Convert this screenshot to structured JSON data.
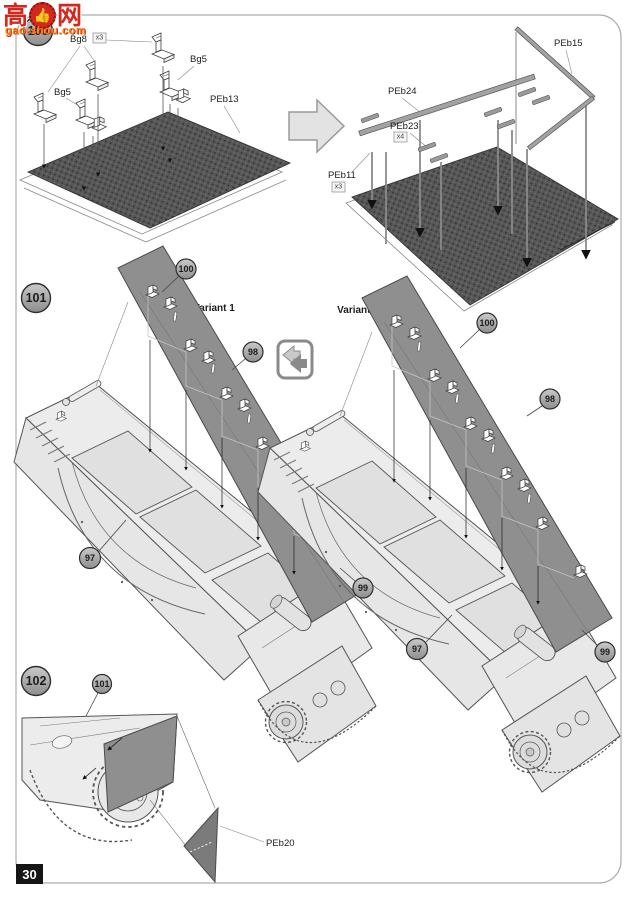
{
  "watermark": {
    "left_char": "高",
    "right_char": "网",
    "thumb": "👍",
    "site": "gao-shou.com"
  },
  "page": {
    "number": "30"
  },
  "colors": {
    "skirt_panel": "#8f8f8f",
    "mesh_plate": "#575757",
    "hull": "#ececec",
    "watermark_red": "#d3281e",
    "watermark_orange": "#ff7a00"
  },
  "steps": {
    "s100": {
      "badge": "100",
      "bg8": "Bg8",
      "bg8_qty": "x3",
      "bg5_a": "Bg5",
      "bg5_b": "Bg5",
      "peb13": "PEb13",
      "peb24": "PEb24",
      "peb23": "PEb23",
      "peb23_qty": "x4",
      "peb11": "PEb11",
      "peb11_qty": "x3",
      "peb15": "PEb15"
    },
    "s101": {
      "badge": "101",
      "variant1": "Variant 1",
      "variant2": "Variant 2",
      "v1": {
        "c100": "100",
        "c98": "98",
        "c97": "97",
        "c99": "99"
      },
      "v2": {
        "c100": "100",
        "c98": "98",
        "c97": "97",
        "c99": "99"
      }
    },
    "s102": {
      "badge": "102",
      "c101": "101",
      "peb20": "PEb20"
    }
  }
}
